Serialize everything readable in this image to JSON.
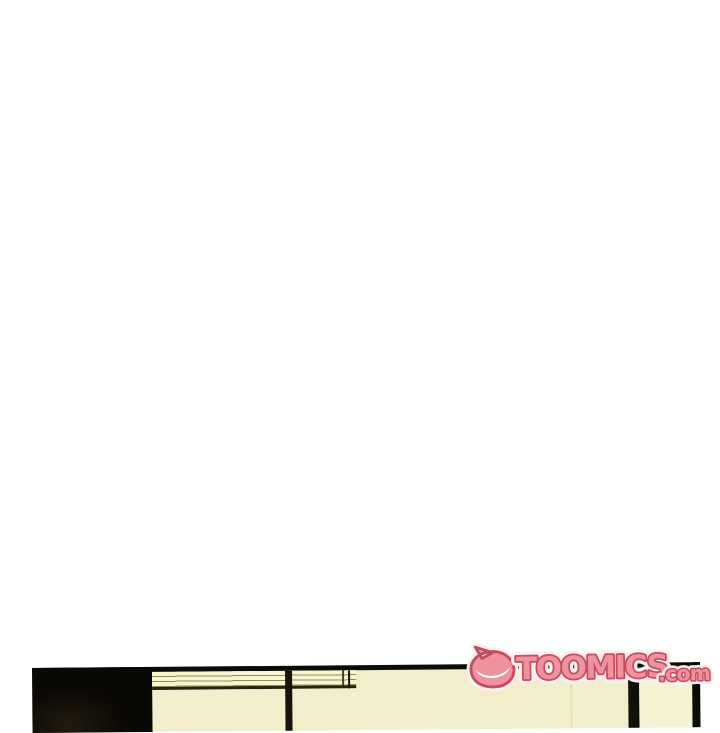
{
  "page": {
    "background_color": "#ffffff"
  },
  "watermark": {
    "brand": "TOOMICS",
    "suffix": ".com",
    "icon": "toomics-mascot-icon",
    "fill_color": "#f0929e",
    "outline_color": "#c24e60",
    "halo_color": "#fdeef0"
  },
  "panel": {
    "border_color": "#0d0b07",
    "dark_wall_color": "#0b0906",
    "blinds_color": "#f7f5cf",
    "blind_slat_color": "#92905a",
    "sill_color": "#26230f",
    "window_frame_color": "#15130b",
    "wall_color": "#f2eecb",
    "wall_right_color": "#f5f1d3",
    "door_frame_color": "#12100a",
    "crease_color": "#ded9a8"
  }
}
